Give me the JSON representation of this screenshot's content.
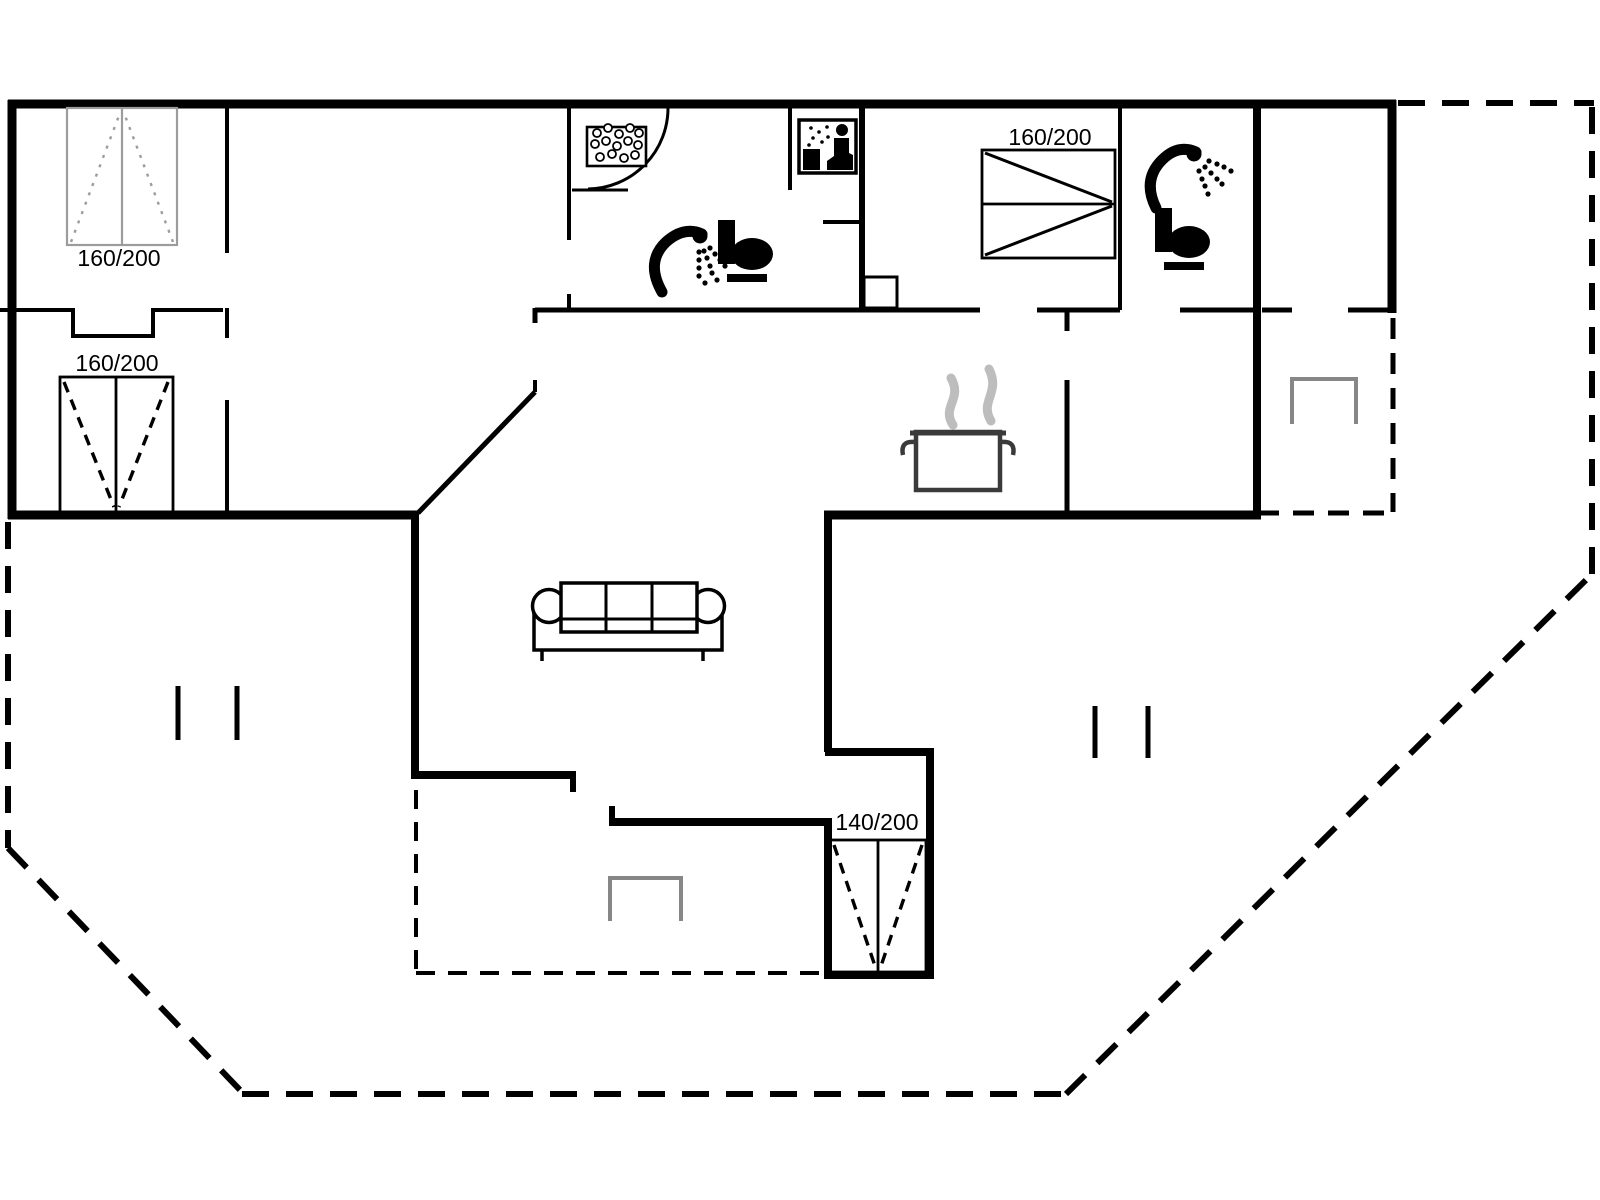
{
  "plan": {
    "type": "holiday-house-floor-plan",
    "background": "#ffffff",
    "wall_color": "#000000",
    "light_gray": "#9c9c9c",
    "steam_gray": "#bdbdbd",
    "beds": [
      {
        "name": "bed-top-left",
        "size_label": "160/200"
      },
      {
        "name": "bed-mid-left",
        "size_label": "160/200"
      },
      {
        "name": "bed-top-right",
        "size_label": "160/200"
      },
      {
        "name": "bed-south",
        "size_label": "140/200"
      }
    ],
    "fixtures": [
      "whirlpool-tub-icon",
      "sauna-icon",
      "shower-icon",
      "toilet-icon",
      "shower-icon",
      "toilet-icon",
      "cooking-pot-icon",
      "sofa-icon",
      "patio-furniture-icon",
      "patio-furniture-icon",
      "terrace-dashed-outline"
    ]
  }
}
